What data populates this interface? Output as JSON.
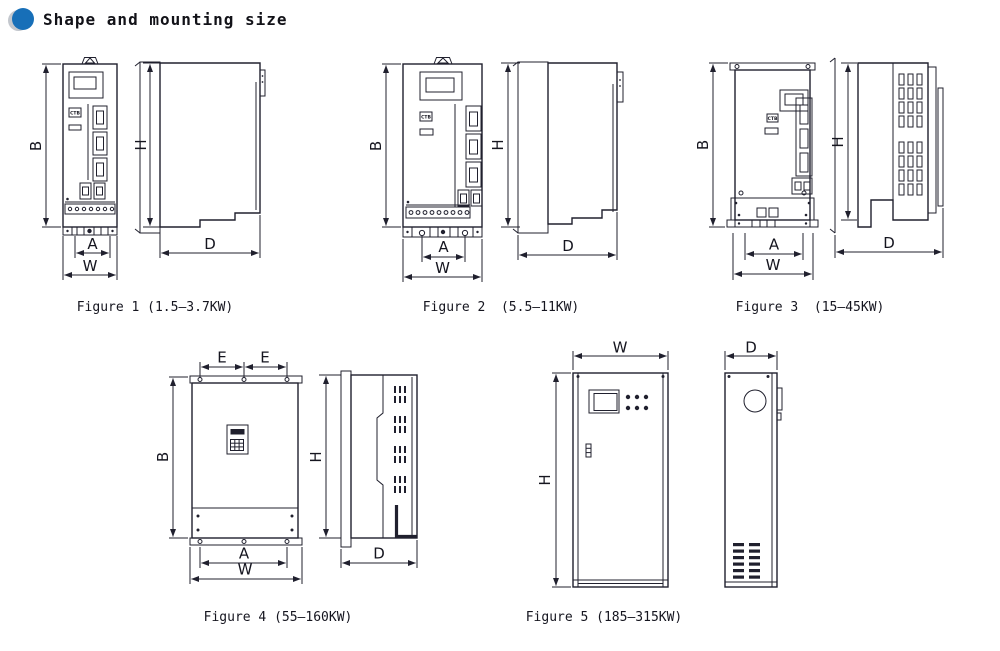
{
  "header": {
    "title": "Shape and mounting size"
  },
  "colors": {
    "line": "#20202e",
    "bullet_blue": "#176fb8",
    "bullet_gray": "#c3c7cd"
  },
  "figures": [
    {
      "caption": "Figure 1 (1.5–3.7KW)",
      "panel_label": "CTB",
      "dims": {
        "B": "B",
        "H": "H",
        "A": "A",
        "W": "W",
        "D": "D"
      }
    },
    {
      "caption": "Figure 2  (5.5–11KW)",
      "panel_label": "CTB",
      "dims": {
        "B": "B",
        "H": "H",
        "A": "A",
        "W": "W",
        "D": "D"
      }
    },
    {
      "caption": "Figure 3  (15–45KW)",
      "panel_label": "CTB",
      "dims": {
        "B": "B",
        "H": "H",
        "A": "A",
        "W": "W",
        "D": "D"
      }
    },
    {
      "caption": "Figure 4 (55–160KW)",
      "dims": {
        "E": "E",
        "B": "B",
        "H": "H",
        "A": "A",
        "W": "W",
        "D": "D"
      }
    },
    {
      "caption": "Figure 5 (185–315KW)",
      "dims": {
        "W": "W",
        "H": "H",
        "D": "D"
      }
    }
  ]
}
